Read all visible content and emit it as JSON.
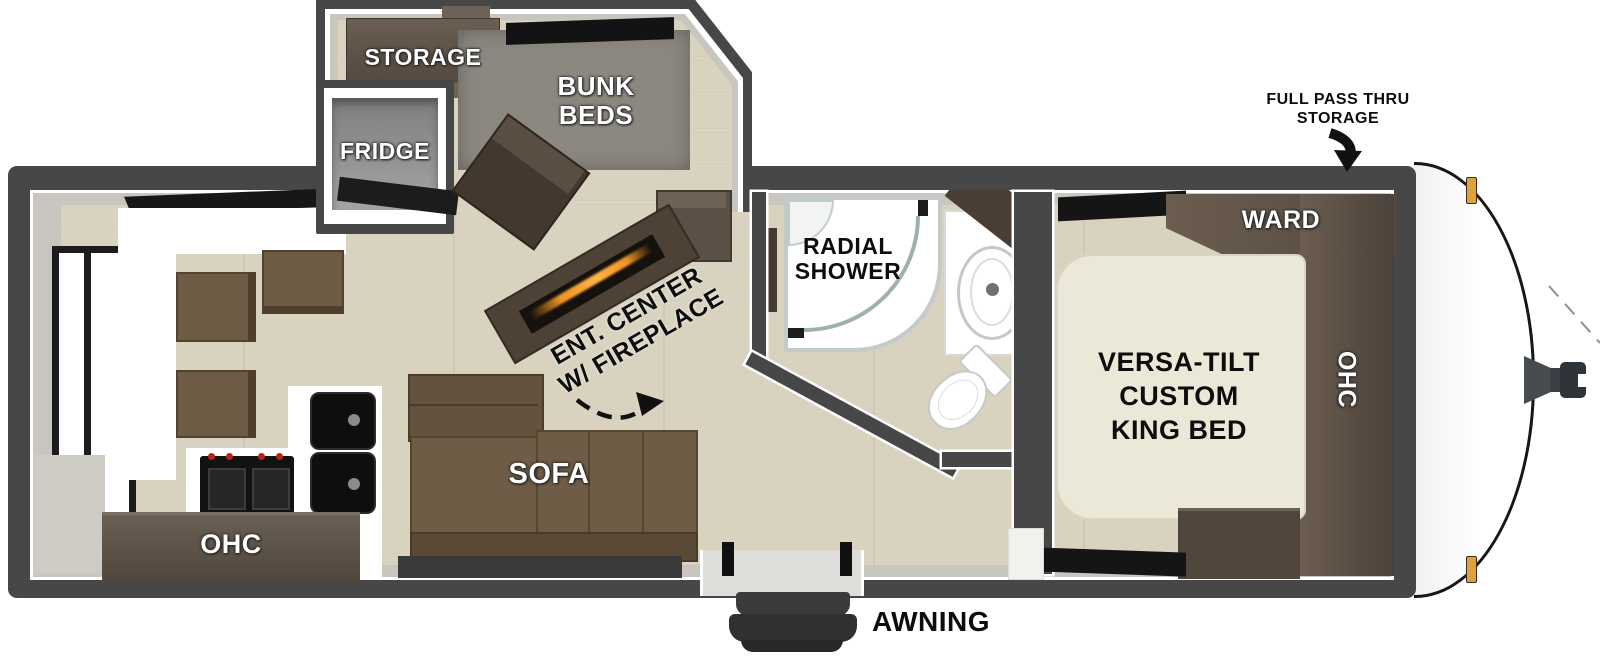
{
  "floorplan": {
    "type": "travel-trailer-floorplan",
    "labels": {
      "storage": "STORAGE",
      "bunk_line1": "BUNK",
      "bunk_line2": "BEDS",
      "fridge": "FRIDGE",
      "shower_line1": "RADIAL",
      "shower_line2": "SHOWER",
      "ent_line1": "ENT. CENTER",
      "ent_line2": "W/ FIREPLACE",
      "sofa": "SOFA",
      "kitchen_ohc": "OHC",
      "awning": "AWNING",
      "bed_line1": "VERSA-TILT",
      "bed_line2": "CUSTOM",
      "bed_line3": "KING BED",
      "ward": "WARD",
      "bedroom_ohc": "OHC",
      "passthru_line1": "FULL PASS THRU",
      "passthru_line2": "STORAGE"
    },
    "colors": {
      "wall": "#474747",
      "floor": "#d8d2bf",
      "liner": "#c9c6c0",
      "cabinet_dark": "#56493e",
      "sofa_brown": "#6e5c46",
      "mattress": "#ece8d7",
      "bunk_mat": "#8c8880",
      "fireplace_glow": "#f09422",
      "marker_light": "#dfa13d"
    }
  }
}
